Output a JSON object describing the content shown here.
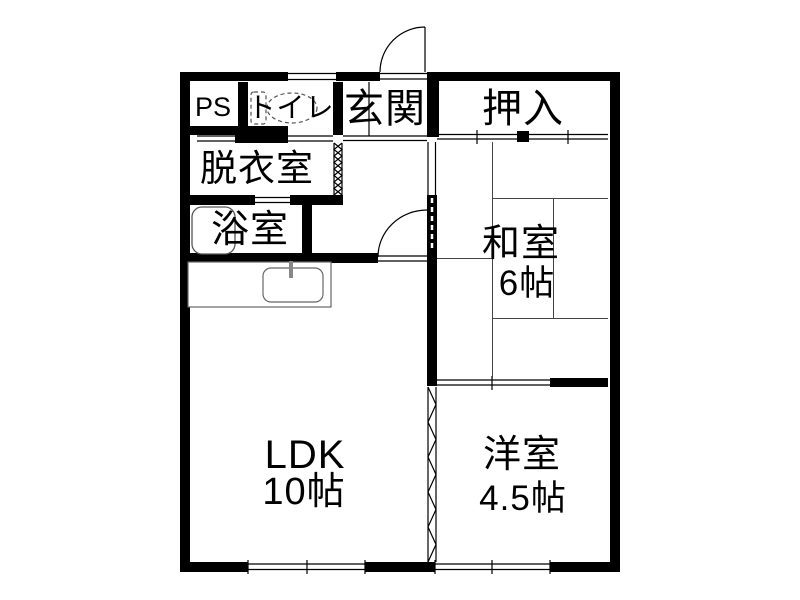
{
  "document": {
    "type": "floor-plan",
    "background_color": "#ffffff",
    "wall_color": "#000000",
    "line_color": "#444444"
  },
  "rooms": {
    "ps": {
      "label": "PS"
    },
    "toilet": {
      "label": "トイレ"
    },
    "entrance": {
      "label": "玄関"
    },
    "closet": {
      "label": "押入"
    },
    "dressing_room": {
      "label": "脱衣室"
    },
    "bathroom": {
      "label": "浴室"
    },
    "japanese_room": {
      "label": "和室",
      "size": "6帖"
    },
    "ldk": {
      "label": "LDK",
      "size": "10帖"
    },
    "western_room": {
      "label": "洋室",
      "size": "4.5帖"
    }
  },
  "fixtures": {
    "toilet_icon": "toilet-icon",
    "bathtub_icon": "bathtub-icon",
    "kitchen_sink_icon": "kitchen-sink-icon",
    "entrance_door_icon": "swing-door-icon",
    "hall_door_icon": "swing-door-icon",
    "accordion_door_icon": "accordion-door-icon",
    "window_icon": "window-icon",
    "sliding_door_icon": "sliding-door-icon"
  }
}
